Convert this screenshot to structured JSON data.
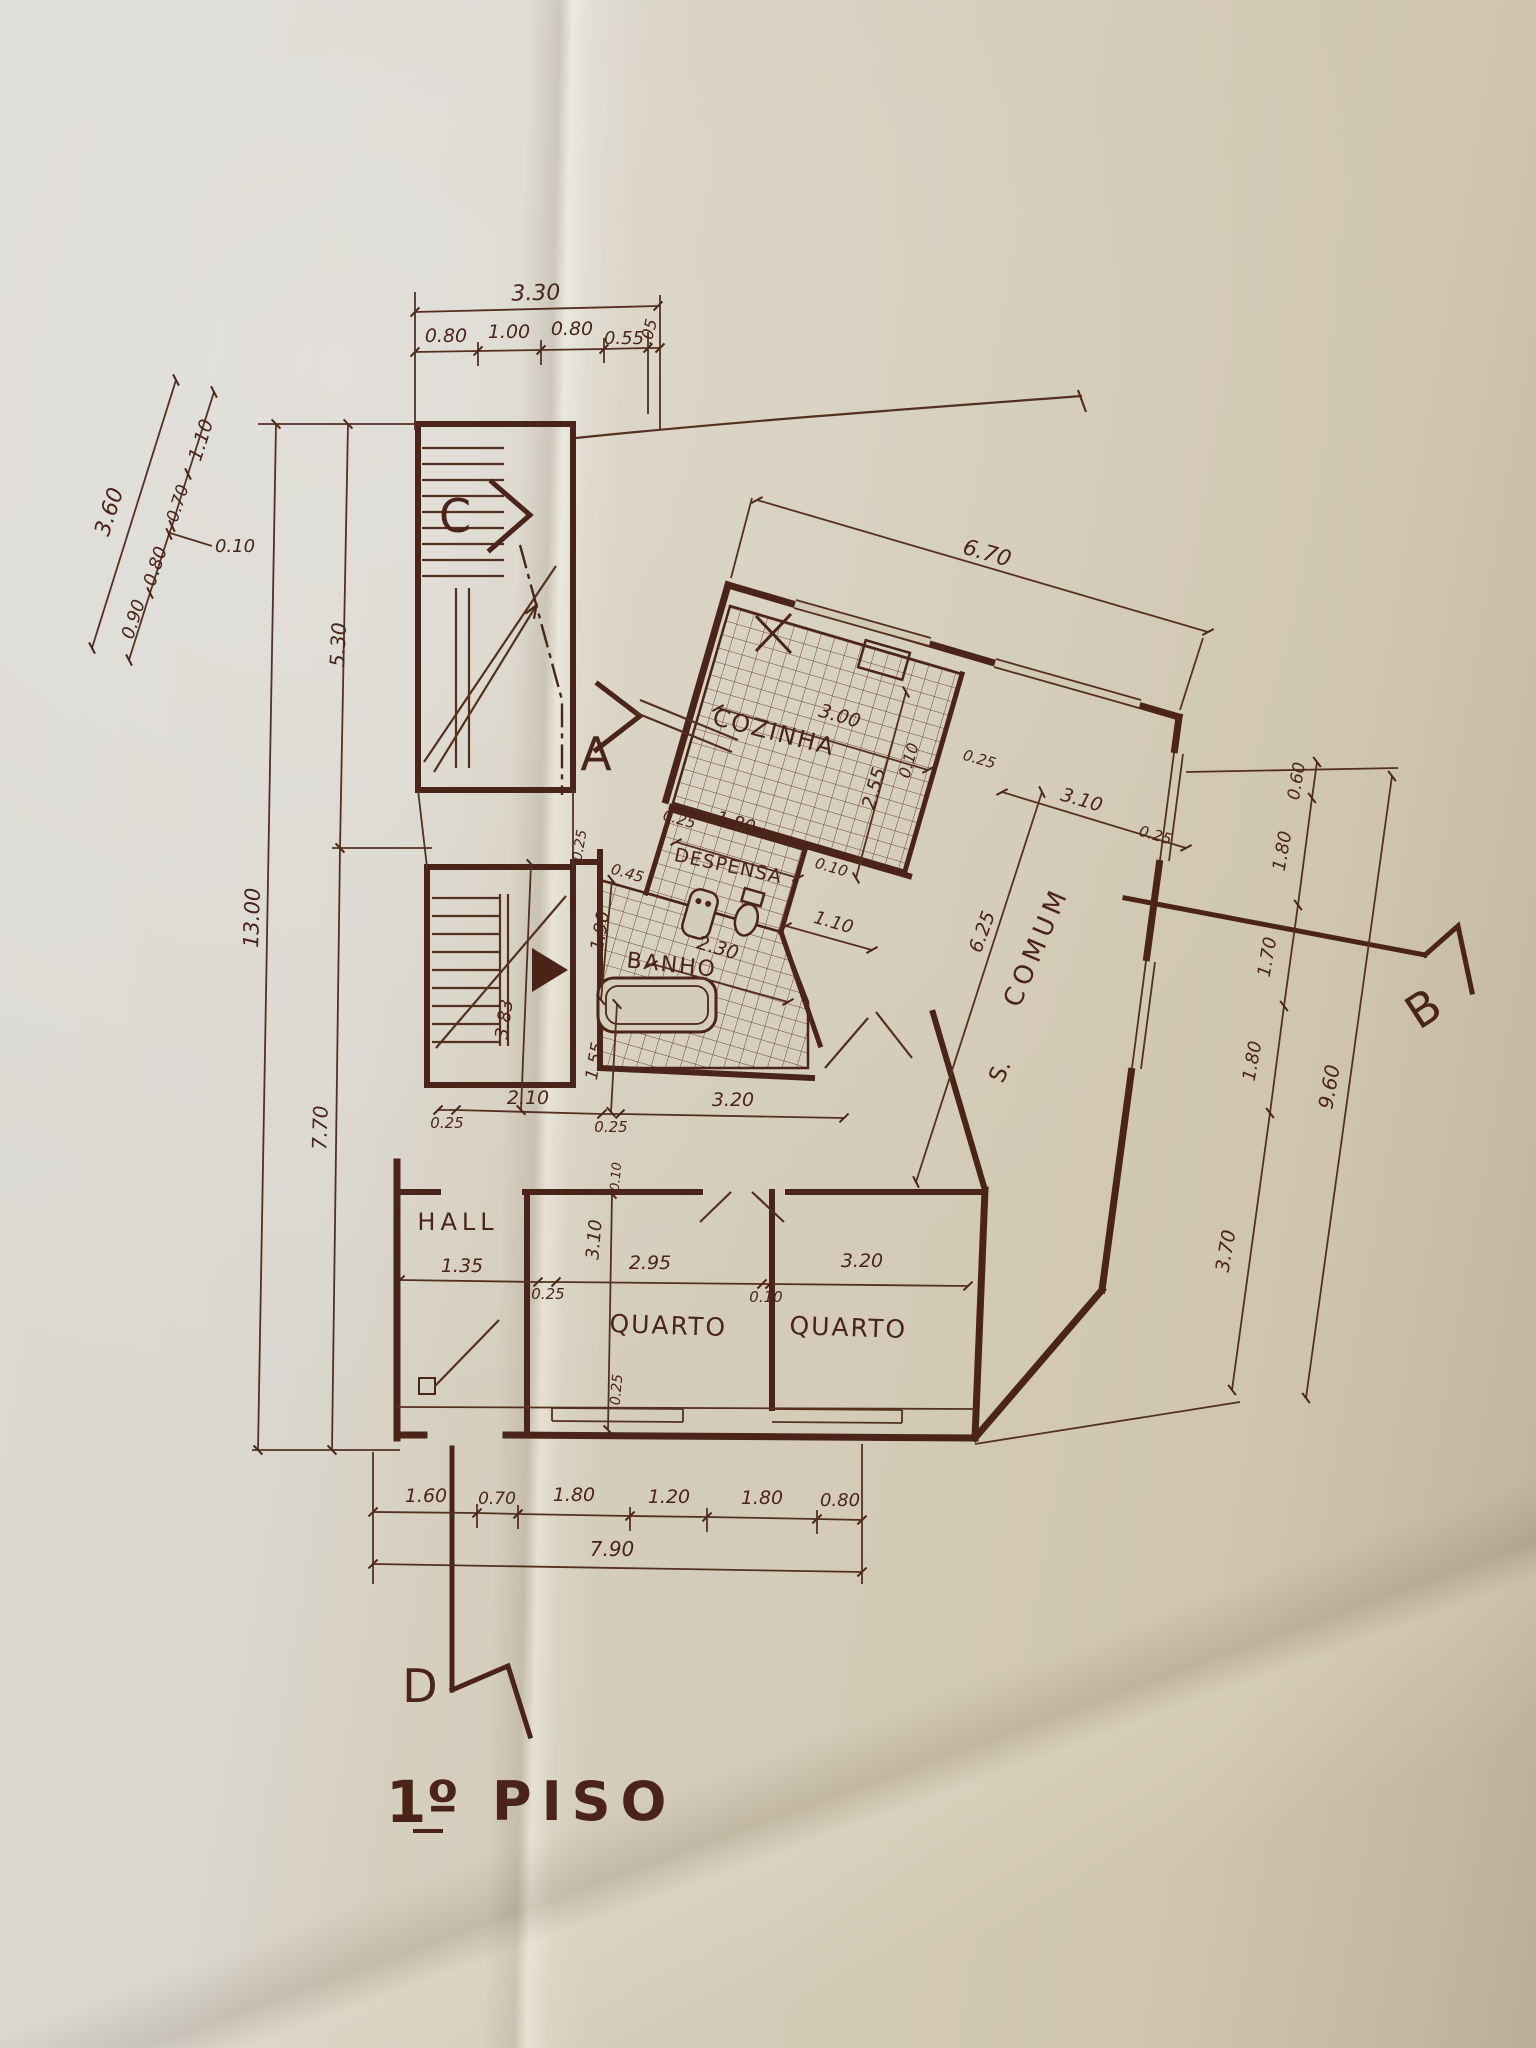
{
  "title": {
    "floor_number": "1º",
    "floor_word": "PISO"
  },
  "rooms": {
    "kitchen": "COZINHA",
    "pantry": "DESPENSA",
    "bathroom": "BANHO",
    "hall": "HALL",
    "bedroom_left": "QUARTO",
    "bedroom_right": "QUARTO",
    "living_prefix": "S.",
    "living": "COMUM"
  },
  "sections": {
    "a": "A",
    "b": "B",
    "c": "C",
    "d": "D"
  },
  "dimensions": {
    "top": {
      "total": "3.30",
      "s": [
        "0.80",
        "1.00",
        "0.80",
        "0.55",
        ".05"
      ]
    },
    "left_diag": {
      "total": "3.60",
      "s": [
        "1.10",
        "0.70",
        "0.10",
        "0.80",
        "0.90"
      ]
    },
    "left_vert": {
      "upper": "5.30",
      "lower": "7.70",
      "total": "13.00"
    },
    "upper_wing": {
      "facade": "6.70",
      "kitchen_width": "3.00",
      "kitchen_depth": "2.55",
      "pantry_width": "1.80",
      "pantry_pass": "1.10",
      "shaft_width": "0.45",
      "shaft_depth": "1.90",
      "bath_width": "2.30",
      "living_width": "3.10",
      "living_length": "6.25"
    },
    "right": {
      "s": [
        "0.60",
        "1.80",
        "1.70",
        "1.80"
      ],
      "total": "9.60",
      "lower": "3.70"
    },
    "corridor": {
      "s": [
        "0.25",
        "2.10",
        "0.25",
        "3.20"
      ],
      "stair_width": "1.55",
      "stair_run": "3.83"
    },
    "bedrooms": {
      "s": [
        "1.35",
        "0.25",
        "2.95",
        "0.10",
        "3.20"
      ],
      "depth": "3.10",
      "sill": "0.25",
      "head": "0.10"
    },
    "bottom": {
      "s": [
        "1.60",
        "0.70",
        "1.80",
        "1.20",
        "1.80",
        "0.80"
      ],
      "total": "7.90"
    },
    "wall_thick": "0.25",
    "wall_thin": "0.10"
  },
  "colors": {
    "ink": "#4a2419",
    "paper_left": "#dcdad4",
    "paper_right": "#c3b8a1"
  }
}
